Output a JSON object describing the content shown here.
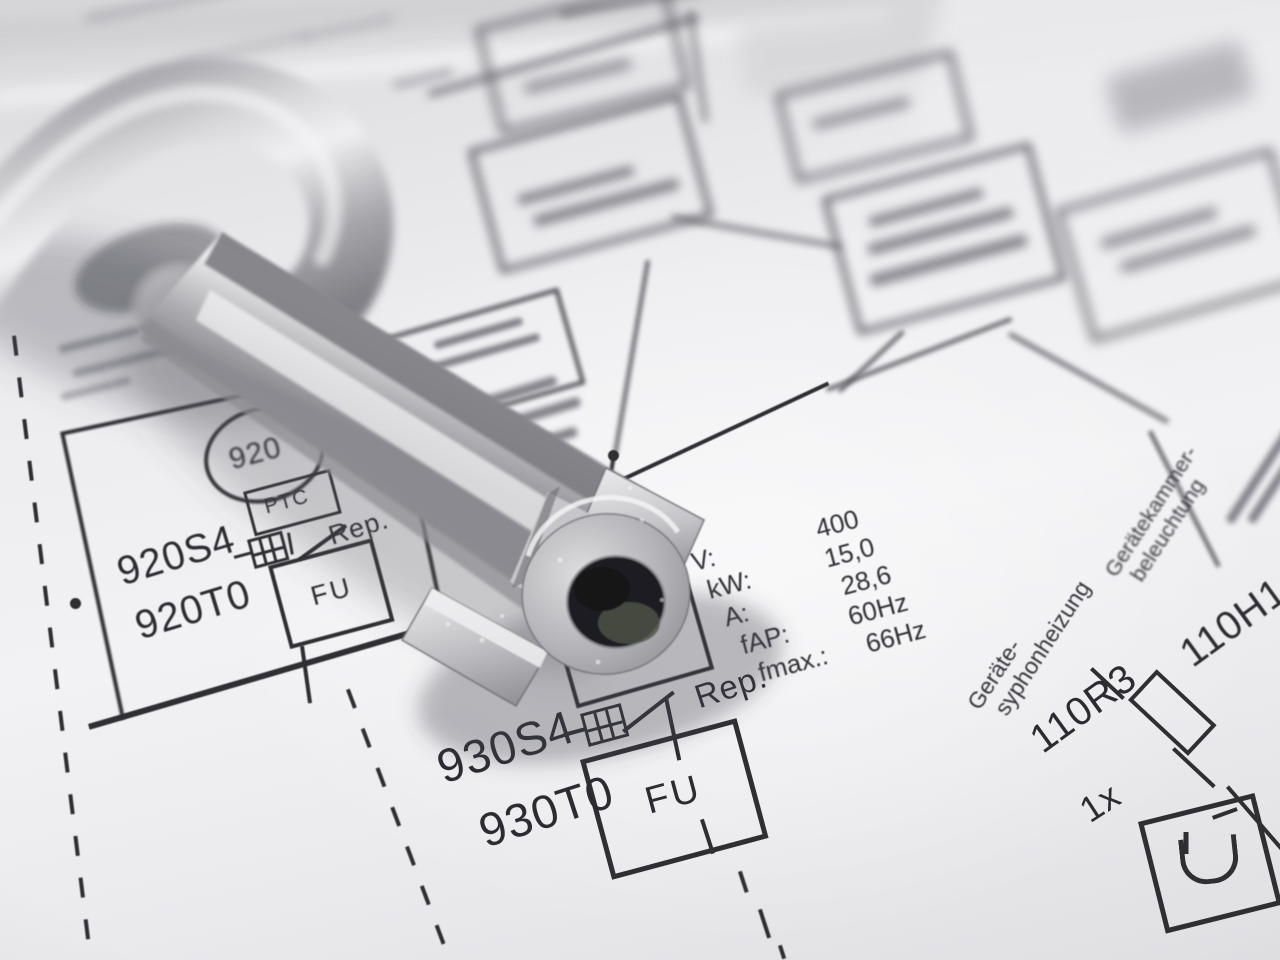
{
  "schematic": {
    "circuit_920": {
      "motor_label": "920",
      "ptc_label": "PTC",
      "switch_id": "920S4",
      "switch_note": "Rep.",
      "inverter_id": "920T0",
      "inverter_box": "FU"
    },
    "circuit_930": {
      "switch_id": "930S4",
      "switch_note": "Rep.",
      "inverter_id": "930T0",
      "inverter_box": "FU"
    },
    "specs": {
      "rows": [
        {
          "label": "V:",
          "value": "400"
        },
        {
          "label": "kW:",
          "value": "15,0"
        },
        {
          "label": "A:",
          "value": "28,6"
        },
        {
          "label": "fAP:",
          "value": "60Hz"
        },
        {
          "label": "fmax.:",
          "value": "66Hz"
        }
      ]
    },
    "circuit_110": {
      "lamp_name_line1": "Gerätekammer-",
      "lamp_name_line2": "beleuchtung",
      "heater_name_line1": "Geräte-",
      "heater_name_line2": "syphonheizung",
      "lamp_id": "110H1",
      "resistor_id": "110R3",
      "quantity": "1x"
    }
  },
  "colors": {
    "ink": "#2e2e33",
    "paper_light": "#f2f2f4",
    "paper_shadow": "#d7d7da",
    "metal_light": "#efeff1",
    "metal_mid": "#c6c6ca",
    "metal_dark": "#7e7e84",
    "key_hole": "#1f1f23"
  }
}
